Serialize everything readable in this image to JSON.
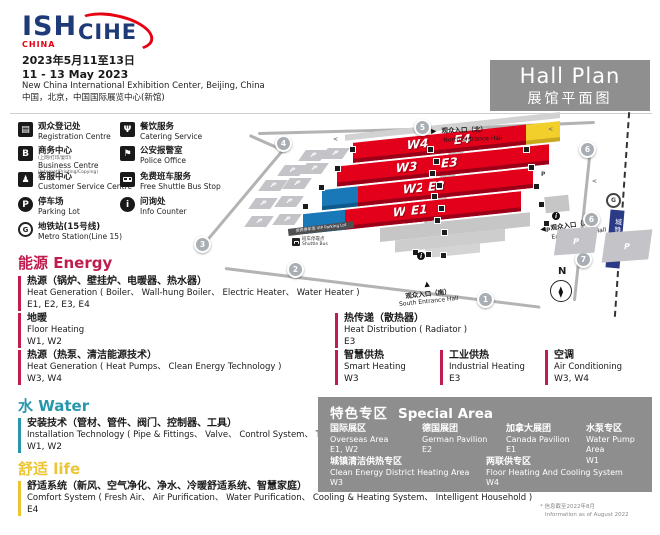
{
  "header": {
    "logo_ish": "ISH",
    "logo_ish_sub": "CHINA",
    "logo_cihe": "CIHE",
    "date_cn": "2023年5月11至13日",
    "date_en": "11 - 13 May 2023",
    "venue_en": "New China International Exhibition Center, Beijing, China",
    "venue_cn": "中国，北京，中国国际展览中心(新馆)",
    "title_en": "Hall Plan",
    "title_cn": "展馆平面图"
  },
  "legend": {
    "items": [
      {
        "cn": "观众登记处",
        "en": "Registration Centre",
        "icon": "registration-icon",
        "glyph": "▤"
      },
      {
        "cn": "餐饮服务",
        "en": "Catering Service",
        "icon": "catering-icon",
        "glyph": "Ψ"
      },
      {
        "cn": "商务中心",
        "cn_note": "(上网/打印/复印)",
        "en": "Business Centre",
        "en_note": "(Internet/Printing/Copying)",
        "icon": "business-centre-icon",
        "glyph": "B"
      },
      {
        "cn": "公安报警室",
        "en": "Police Office",
        "icon": "police-icon",
        "glyph": "⚑"
      },
      {
        "cn": "客服中心",
        "en": "Customer Service Centre",
        "icon": "customer-service-icon",
        "glyph": "♟"
      },
      {
        "cn": "免费班车服务",
        "en": "Free Shuttle Bus Stop",
        "icon": "shuttle-bus-icon",
        "glyph": ""
      },
      {
        "cn": "停车场",
        "en": "Parking Lot",
        "icon": "parking-icon",
        "glyph": "P"
      },
      {
        "cn": "问询处",
        "en": "Info Counter",
        "icon": "info-icon",
        "glyph": "i"
      },
      {
        "cn": "地铁站(15号线)",
        "en": "Metro Station(Line 15)",
        "icon": "metro-icon",
        "glyph": "G"
      }
    ]
  },
  "map": {
    "halls": {
      "west": [
        "W4",
        "W3",
        "W2",
        "W1"
      ],
      "east": [
        "E4",
        "E3",
        "E2",
        "E1"
      ]
    },
    "entrances": {
      "north": {
        "cn": "观众入口（北）",
        "en": "North Entrance Hall"
      },
      "east": {
        "cn": "观众入口（东）",
        "en": "East Entrance Hall"
      },
      "south": {
        "cn": "观众入口（南）",
        "en": "South Entrance Hall"
      }
    },
    "metro_line_label": "城铁15号线",
    "metro_logo_letter": "G",
    "compass": "N",
    "parking_letter": "P",
    "shuttle_stop": {
      "cn": "班车停靠点",
      "en": "Shuttle Bus"
    },
    "vip_parking": {
      "cn": "贵宾停车场",
      "en": "VIP Parking Lot"
    },
    "markers": {
      "m1": "1",
      "m2": "2",
      "m3": "3",
      "m4": "4",
      "m5": "5",
      "m6a": "6",
      "m6b": "6",
      "m7": "7"
    }
  },
  "sections": {
    "energy": {
      "heading_cn": "能源",
      "heading_en": "Energy",
      "color": "#c01c4e",
      "items": [
        {
          "cn": "热源（锅炉、壁挂炉、电暖器、热水器）",
          "en": "Heat Generation ( Boiler、 Wall-hung Boiler、 Electric Heater、 Water Heater )",
          "halls": "E1, E2, E3, E4"
        },
        {
          "cn": "地暖",
          "en": "Floor Heating",
          "halls": "W1, W2"
        },
        {
          "cn": "热源（热泵、清洁能源技术）",
          "en": "Heat Generation ( Heat Pumps、 Clean Energy Technology )",
          "halls": "W3, W4"
        },
        {
          "cn": "热传递（散热器）",
          "en": "Heat Distribution ( Radiator )",
          "halls": "E3"
        },
        {
          "cn": "智慧供热",
          "en": "Smart Heating",
          "halls": "W3"
        },
        {
          "cn": "工业供热",
          "en": "Industrial Heating",
          "halls": "E3"
        },
        {
          "cn": "空调",
          "en": "Air Conditioning",
          "halls": "W3, W4"
        }
      ]
    },
    "water": {
      "heading_cn": "水",
      "heading_en": "Water",
      "color": "#2896ab",
      "items": [
        {
          "cn": "安装技术（管材、管件、阀门、控制器、工具）",
          "en": "Installation Technology ( Pipe & Fittings、 Valve、 Control System、 Tools )",
          "halls": "W1, W2"
        }
      ]
    },
    "life": {
      "heading_cn": "舒适",
      "heading_en": "life",
      "color": "#edc431",
      "items": [
        {
          "cn": "舒适系统（新风、空气净化、净水、冷暖舒适系统、智慧家庭）",
          "en": "Comfort System ( Fresh Air、 Air Purification、 Water Purification、 Cooling & Heating System、 Intelligent Household )",
          "halls": "E4"
        }
      ]
    }
  },
  "special_area": {
    "title_cn": "特色专区",
    "title_en": "Special Area",
    "items": [
      {
        "cn": "国际展区",
        "en": "Overseas Area",
        "halls": "E1, W2"
      },
      {
        "cn": "德国展团",
        "en": "German Pavilion",
        "halls": "E2"
      },
      {
        "cn": "加拿大展团",
        "en": "Canada Pavilion",
        "halls": "E1"
      },
      {
        "cn": "水泵专区",
        "en": "Water Pump Area",
        "halls": "W1"
      },
      {
        "cn": "城镇清洁供热专区",
        "en": "Clean Energy District Heating Area",
        "halls": "W3"
      },
      {
        "cn": "两联供专区",
        "en": "Floor Heating And Cooling System",
        "halls": "W4"
      }
    ]
  },
  "footnote": {
    "line1": "* 信息截至2022年8月",
    "line2": "Information as of August 2022"
  },
  "colors": {
    "navy": "#1e3a78",
    "brand_red": "#e60012",
    "hall_red": "#e2001a",
    "hall_blue": "#1878b8",
    "hall_yellow": "#f2cf2a",
    "energy": "#c01c4e",
    "water": "#2896ab",
    "life": "#edc431",
    "box_gray": "#8e8e8e"
  }
}
